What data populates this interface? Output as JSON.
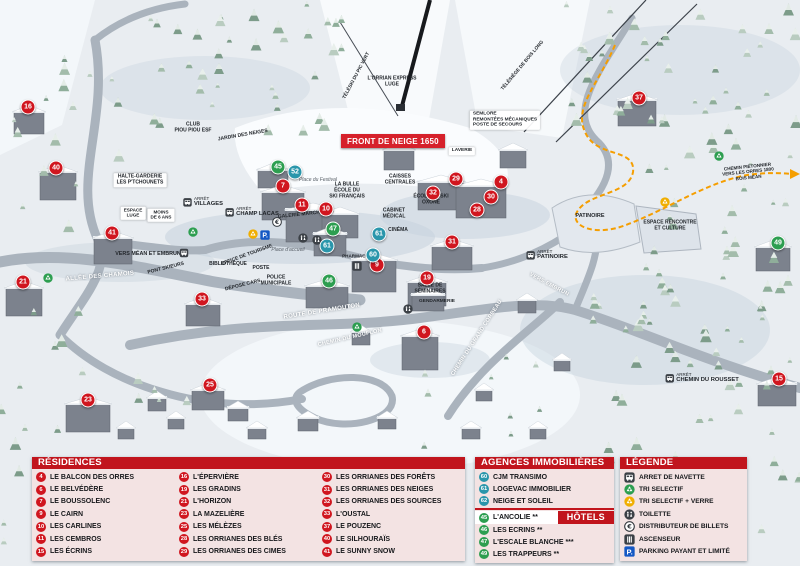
{
  "colors": {
    "header_red": "#c1151d",
    "panel_pink": "#f3e2e2",
    "banner_red": "#d6212b",
    "residence": "#d0161f",
    "agency": "#2a96ab",
    "hotel": "#2d9e50",
    "recycle_green": "#2d9e50",
    "recycle_yellow": "#f0ae00",
    "parking_blue": "#1458c4",
    "path_orange": "#f59e00"
  },
  "map": {
    "banner": "FRONT DE NEIGE 1650",
    "arret_label": "ARRÊT",
    "markers": [
      {
        "n": 16,
        "cat": "residence",
        "x": 28,
        "y": 107
      },
      {
        "n": 40,
        "cat": "residence",
        "x": 56,
        "y": 168
      },
      {
        "n": 41,
        "cat": "residence",
        "x": 112,
        "y": 233
      },
      {
        "n": 21,
        "cat": "residence",
        "x": 23,
        "y": 282
      },
      {
        "n": 23,
        "cat": "residence",
        "x": 88,
        "y": 400
      },
      {
        "n": 25,
        "cat": "residence",
        "x": 210,
        "y": 385
      },
      {
        "n": 33,
        "cat": "residence",
        "x": 202,
        "y": 299
      },
      {
        "n": 7,
        "cat": "residence",
        "x": 283,
        "y": 186
      },
      {
        "n": 11,
        "cat": "residence",
        "x": 302,
        "y": 205
      },
      {
        "n": 10,
        "cat": "residence",
        "x": 326,
        "y": 209
      },
      {
        "n": 9,
        "cat": "residence",
        "x": 377,
        "y": 265
      },
      {
        "n": 19,
        "cat": "residence",
        "x": 427,
        "y": 278
      },
      {
        "n": 6,
        "cat": "residence",
        "x": 424,
        "y": 332
      },
      {
        "n": 29,
        "cat": "residence",
        "x": 456,
        "y": 179
      },
      {
        "n": 32,
        "cat": "residence",
        "x": 433,
        "y": 193
      },
      {
        "n": 4,
        "cat": "residence",
        "x": 501,
        "y": 182
      },
      {
        "n": 30,
        "cat": "residence",
        "x": 491,
        "y": 197
      },
      {
        "n": 28,
        "cat": "residence",
        "x": 477,
        "y": 210
      },
      {
        "n": 31,
        "cat": "residence",
        "x": 452,
        "y": 242
      },
      {
        "n": 37,
        "cat": "residence",
        "x": 639,
        "y": 98
      },
      {
        "n": 15,
        "cat": "residence",
        "x": 779,
        "y": 379
      },
      {
        "n": 52,
        "cat": "agency",
        "x": 295,
        "y": 172
      },
      {
        "n": 61,
        "cat": "agency",
        "x": 379,
        "y": 234
      },
      {
        "n": 61,
        "cat": "agency",
        "x": 327,
        "y": 246
      },
      {
        "n": 60,
        "cat": "agency",
        "x": 373,
        "y": 255
      },
      {
        "n": 45,
        "cat": "hotel",
        "x": 278,
        "y": 167
      },
      {
        "n": 47,
        "cat": "hotel",
        "x": 333,
        "y": 229
      },
      {
        "n": 46,
        "cat": "hotel",
        "x": 329,
        "y": 281
      },
      {
        "n": 49,
        "cat": "hotel",
        "x": 778,
        "y": 243
      }
    ],
    "labels": [
      {
        "t": "CLUB\nPIOU PIOU ESF",
        "x": 193,
        "y": 128,
        "s": "plain",
        "sz": 5
      },
      {
        "t": "JARDIN DES NEIGES",
        "x": 243,
        "y": 136,
        "s": "plain",
        "sz": 5,
        "r": -10
      },
      {
        "t": "HALTE-GARDERIE\nLES P'TCHOUNETS",
        "x": 140,
        "y": 180,
        "s": "chip",
        "sz": 5
      },
      {
        "t": "ESPACE\nLUGE",
        "x": 133,
        "y": 213,
        "s": "chip",
        "sz": 4.6
      },
      {
        "t": "MOINS\nDE 6 ANS",
        "x": 161,
        "y": 215,
        "s": "chip",
        "sz": 4.6
      },
      {
        "t": "VERS MÉAN ET EMBRUN",
        "x": 148,
        "y": 254,
        "s": "plain",
        "sz": 5.4
      },
      {
        "t": "PONT SKIEURS",
        "x": 166,
        "y": 269,
        "s": "plain",
        "sz": 5,
        "r": -14
      },
      {
        "t": "ALLÉE DES CHAMOIS",
        "x": 100,
        "y": 277,
        "s": "road",
        "sz": 6,
        "r": -5
      },
      {
        "t": "ROUTE DE PRAMOUTON",
        "x": 322,
        "y": 312,
        "s": "road",
        "sz": 6,
        "r": -9
      },
      {
        "t": "CHEMIN DU MOUFLON",
        "x": 350,
        "y": 338,
        "s": "road",
        "sz": 5.5,
        "r": -13
      },
      {
        "t": "CHEMIN DU GRAND CORBEAU",
        "x": 477,
        "y": 338,
        "s": "road",
        "sz": 5.5,
        "r": -57
      },
      {
        "t": "OFFICE DE TOURISME",
        "x": 247,
        "y": 256,
        "s": "plain",
        "sz": 5,
        "r": -20
      },
      {
        "t": "BIBLIOTHÈQUE",
        "x": 228,
        "y": 265,
        "s": "plain",
        "sz": 5
      },
      {
        "t": "POSTE",
        "x": 261,
        "y": 269,
        "s": "plain",
        "sz": 5
      },
      {
        "t": "POLICE\nMUNICIPALE",
        "x": 276,
        "y": 281,
        "s": "plain",
        "sz": 5
      },
      {
        "t": "DÉPOSE CARS",
        "x": 243,
        "y": 286,
        "s": "plain",
        "sz": 5,
        "r": -14
      },
      {
        "t": "Place d'accueil",
        "x": 288,
        "y": 251,
        "s": "place",
        "sz": 5
      },
      {
        "t": "Place du Festival",
        "x": 318,
        "y": 181,
        "s": "place",
        "sz": 5
      },
      {
        "t": "GALERIE MARCHANDE",
        "x": 306,
        "y": 215,
        "s": "plain",
        "sz": 5,
        "r": -6
      },
      {
        "t": "LA BULLE\nÉCOLE DU\nSKI FRANÇAIS",
        "x": 347,
        "y": 191,
        "s": "plain",
        "sz": 5
      },
      {
        "t": "CAISSES\nCENTRALES",
        "x": 400,
        "y": 180,
        "s": "plain",
        "sz": 5
      },
      {
        "t": "CABINET\nMÉDICAL",
        "x": 394,
        "y": 214,
        "s": "plain",
        "sz": 5
      },
      {
        "t": "CINÉMA",
        "x": 398,
        "y": 231,
        "s": "plain",
        "sz": 5
      },
      {
        "t": "PHARMACIE",
        "x": 356,
        "y": 256,
        "s": "plain",
        "sz": 4.6
      },
      {
        "t": "ÉCOLE DE SKI\nOXONE",
        "x": 431,
        "y": 200,
        "s": "plain",
        "sz": 5
      },
      {
        "t": "LAVERIE",
        "x": 462,
        "y": 151,
        "s": "chip",
        "sz": 4.8
      },
      {
        "t": "SEMLORE\nREMONTÉES MÉCANIQUES\nPOSTE DE SECOURS",
        "x": 505,
        "y": 120,
        "s": "chip-left",
        "sz": 4.8
      },
      {
        "t": "L'ORRIAN EXPRESS\nLUGE",
        "x": 392,
        "y": 82,
        "s": "plain",
        "sz": 5
      },
      {
        "t": "TÉLÉSKI DU PIC VERT",
        "x": 357,
        "y": 76,
        "s": "plain",
        "sz": 4.8,
        "r": -62
      },
      {
        "t": "TÉLÉSIÈGE DE BOIS LONG",
        "x": 523,
        "y": 66,
        "s": "plain",
        "sz": 4.8,
        "r": -50
      },
      {
        "t": "PATINOIRE",
        "x": 590,
        "y": 216,
        "s": "plain",
        "sz": 5.5
      },
      {
        "t": "ESPACE RENCONTRE\nET CULTURE",
        "x": 670,
        "y": 226,
        "s": "plain",
        "sz": 5
      },
      {
        "t": "CHEMIN PIÉTONNIER\nVERS LES ORRES 1800\nBOIS MÉAN",
        "x": 748,
        "y": 172,
        "s": "plain",
        "sz": 4.6,
        "r": -6
      },
      {
        "t": "SALLE DE\nSÉMINAIRES",
        "x": 430,
        "y": 289,
        "s": "plain",
        "sz": 5
      },
      {
        "t": "GENDARMERIE",
        "x": 437,
        "y": 302,
        "s": "plain",
        "sz": 4.8
      },
      {
        "t": "VERS EMBRUN",
        "x": 549,
        "y": 285,
        "s": "road",
        "sz": 5.5,
        "r": 28
      }
    ],
    "bus_stops": [
      {
        "name": "VILLAGES",
        "x": 203,
        "y": 202
      },
      {
        "name": "CHAMP LACAS",
        "x": 252,
        "y": 212
      },
      {
        "name": "",
        "x": 184,
        "y": 253
      },
      {
        "name": "PATINOIRE",
        "x": 547,
        "y": 255
      },
      {
        "name": "CHEMIN DU ROUSSET",
        "x": 702,
        "y": 378
      }
    ],
    "icons": [
      {
        "k": "atm",
        "x": 277,
        "y": 223
      },
      {
        "k": "toilet",
        "x": 303,
        "y": 239
      },
      {
        "k": "toilet",
        "x": 317,
        "y": 241
      },
      {
        "k": "toilet",
        "x": 408,
        "y": 310
      },
      {
        "k": "elevator",
        "x": 357,
        "y": 267
      },
      {
        "k": "recycle",
        "x": 193,
        "y": 233
      },
      {
        "k": "recycle",
        "x": 48,
        "y": 279
      },
      {
        "k": "recycle",
        "x": 357,
        "y": 328
      },
      {
        "k": "recycle",
        "x": 719,
        "y": 157
      },
      {
        "k": "recycleglass",
        "x": 253,
        "y": 235
      },
      {
        "k": "recycleglass",
        "x": 665,
        "y": 203
      },
      {
        "k": "parking",
        "x": 265,
        "y": 236
      }
    ]
  },
  "legend": {
    "residences": {
      "title": "RÉSIDENCES",
      "items": [
        {
          "n": 4,
          "name": "LE BALCON DES ORRES"
        },
        {
          "n": 6,
          "name": "LE BELVÉDÈRE"
        },
        {
          "n": 7,
          "name": "LE BOUSSOLENC"
        },
        {
          "n": 9,
          "name": "LE CAIRN"
        },
        {
          "n": 10,
          "name": "LES CARLINES"
        },
        {
          "n": 11,
          "name": "LES CEMBROS"
        },
        {
          "n": 15,
          "name": "LES ÉCRINS"
        },
        {
          "n": 16,
          "name": "L'ÉPERVIÈRE"
        },
        {
          "n": 19,
          "name": "LES GRADINS"
        },
        {
          "n": 21,
          "name": "L'HORIZON"
        },
        {
          "n": 23,
          "name": "LA MAZELIÈRE"
        },
        {
          "n": 25,
          "name": "LES MÉLÈZES"
        },
        {
          "n": 28,
          "name": "LES ORRIANES DES BLÉS"
        },
        {
          "n": 29,
          "name": "LES ORRIANES DES CIMES"
        },
        {
          "n": 30,
          "name": "LES ORRIANES DES FORÊTS"
        },
        {
          "n": 31,
          "name": "LES ORRIANES DES NEIGES"
        },
        {
          "n": 32,
          "name": "LES ORRIANES DES SOURCES"
        },
        {
          "n": 33,
          "name": "L'OUSTAL"
        },
        {
          "n": 37,
          "name": "LE POUZENC"
        },
        {
          "n": 40,
          "name": "LE SILHOURAÏS"
        },
        {
          "n": 41,
          "name": "LE SUNNY SNOW"
        }
      ]
    },
    "agencies": {
      "title": "AGENCES IMMOBILIÈRES",
      "items": [
        {
          "n": 60,
          "name": "CJM TRANSIMO"
        },
        {
          "n": 61,
          "name": "LOGEVAC IMMOBILIER"
        },
        {
          "n": 62,
          "name": "NEIGE ET SOLEIL"
        }
      ]
    },
    "hotels": {
      "title": "HÔTELS",
      "items": [
        {
          "n": 45,
          "name": "L'ANCOLIE **"
        },
        {
          "n": 46,
          "name": "LES ECRINS **"
        },
        {
          "n": 47,
          "name": "L'ESCALE BLANCHE ***"
        },
        {
          "n": 49,
          "name": "LES TRAPPEURS **"
        }
      ]
    },
    "key": {
      "title": "LÉGENDE",
      "items": [
        {
          "icon": "bus",
          "label": "ARRET DE NAVETTE"
        },
        {
          "icon": "recycle",
          "label": "TRI SELECTIF"
        },
        {
          "icon": "recycleglass",
          "label": "TRI SELECTIF + VERRE"
        },
        {
          "icon": "toilet",
          "label": "TOILETTE"
        },
        {
          "icon": "atm",
          "label": "DISTRIBUTEUR DE BILLETS"
        },
        {
          "icon": "elevator",
          "label": "ASCENSEUR"
        },
        {
          "icon": "parking",
          "label": "PARKING PAYANT ET LIMITÉ"
        }
      ]
    }
  }
}
